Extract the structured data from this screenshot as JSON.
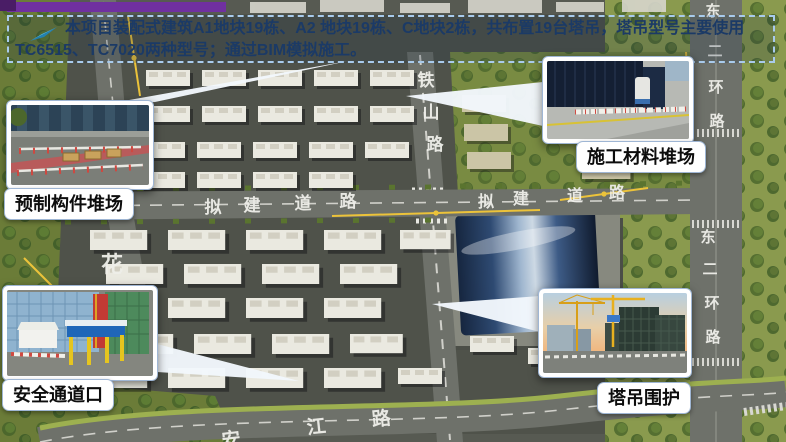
{
  "banner": {
    "line1": "本项目装配式建筑A1地块19栋、A2 地块19栋、C地块2栋，共布置19台塔吊，塔吊型号主要使用",
    "line2": "TC6515、TC7020两种型号；通过BIM模拟施工。",
    "icon": "paper-plane-arrow-icon",
    "colors": {
      "border": "#A9CBEC",
      "text": "#1B3A66",
      "accent_bar": "#7030A0",
      "arrow": "#2FA8E8"
    }
  },
  "callouts": [
    {
      "id": "precast-component-yard",
      "label": "预制构件堆场",
      "position": "top-left"
    },
    {
      "id": "construction-material-yard",
      "label": "施工材料堆场",
      "position": "top-right"
    },
    {
      "id": "safety-passage-entrance",
      "label": "安全通道口",
      "position": "bottom-left"
    },
    {
      "id": "tower-crane-enclosure",
      "label": "塔吊围护",
      "position": "bottom-right"
    }
  ],
  "map": {
    "label_color": "#EFEFEA",
    "crane_line_color": "#ECC33A",
    "roads": {
      "tieshan": [
        "铁",
        "山",
        "路"
      ],
      "nijian_west": [
        "拟",
        "建",
        "道",
        "路"
      ],
      "nijian_east": [
        "拟",
        "建",
        "道",
        "路"
      ],
      "dong_er_huan_north": [
        "东",
        "二",
        "环",
        "路"
      ],
      "dong_er_huan_south": [
        "东",
        "二",
        "环",
        "路"
      ],
      "hua": "花",
      "anjiang": [
        "安",
        "江",
        "路"
      ]
    }
  }
}
